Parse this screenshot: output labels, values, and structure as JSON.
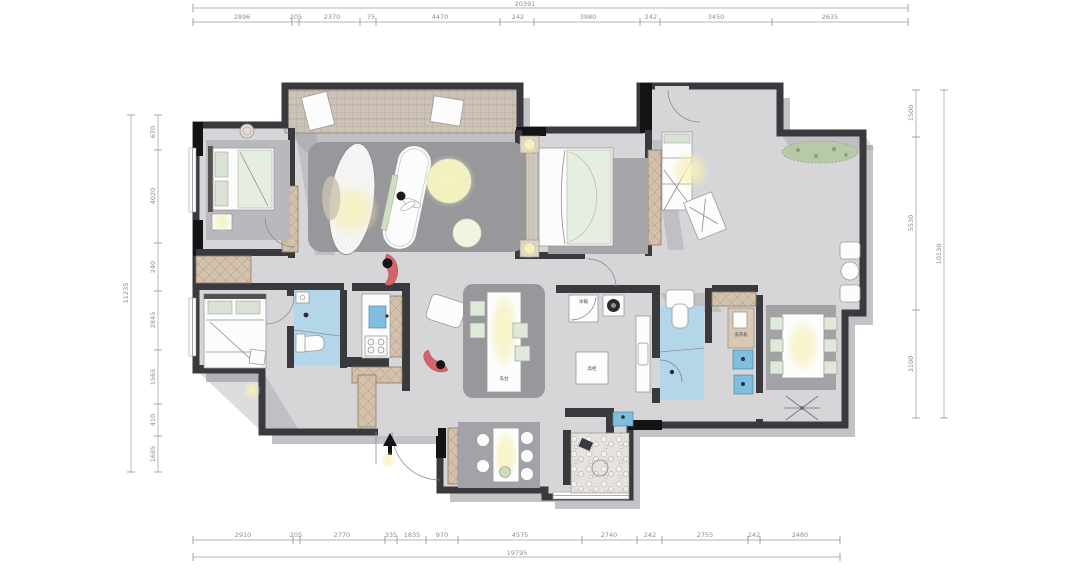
{
  "drawing": {
    "type": "apartment-floor-plan",
    "units": "mm"
  },
  "dims": {
    "top_overall": "20391",
    "top": [
      "2896",
      "205",
      "2370",
      "75",
      "4470",
      "242",
      "3980",
      "242",
      "3450",
      "2635"
    ],
    "bottom_overall": "19795",
    "bottom": [
      "2910",
      "205",
      "2770",
      "335",
      "1835",
      "970",
      "4575",
      "2740",
      "242",
      "2755",
      "242",
      "2480"
    ],
    "left_overall": "11235",
    "left": [
      "670",
      "4020",
      "240",
      "2845",
      "1565",
      "410",
      "1685"
    ],
    "right_overall": "10130",
    "right": [
      "1500",
      "5530",
      "3100"
    ]
  },
  "room_labels": {
    "fridge": "冰箱",
    "tall_cabinet": "高柜",
    "island": "岛台",
    "laundry": "洗衣机"
  },
  "colors": {
    "wall": "#3a393d",
    "floor": "#d6d5d8",
    "rug": "#98979c",
    "wet_area": "#b3d6e8",
    "fixture_blue": "#7fbede",
    "wood_cabinet": "#d3c1ab",
    "plant_green": "#b7c9a6",
    "lamp_glow": "#f6efbe",
    "fish_red": "#d4646a",
    "dim_text": "#8e8e8e",
    "background": "#ffffff"
  }
}
